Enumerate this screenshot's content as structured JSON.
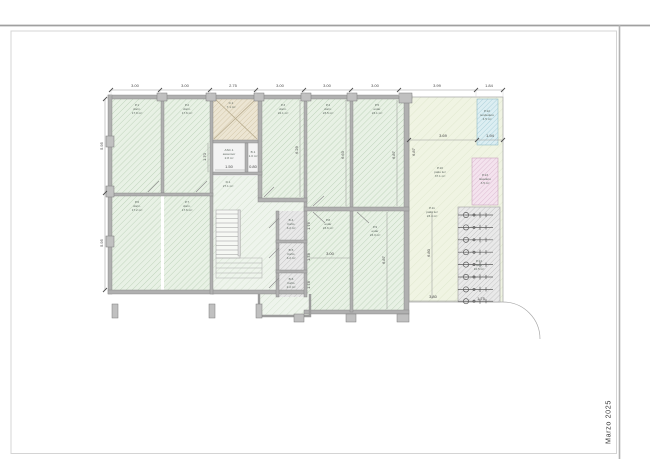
{
  "sheet": {
    "date_label": "Marzo 2025"
  },
  "dims": {
    "top": [
      "3.00",
      "3.00",
      "2.75",
      "3.00",
      "3.00",
      "3.00",
      "3.99",
      "1.84"
    ],
    "left": [
      "5.95",
      "5.95"
    ],
    "patio_row": [
      "3.69",
      "1.94"
    ],
    "v_asc": "1.70",
    "v_room3": "6.29",
    "v_room4": "6.63",
    "v_room5": "6.87",
    "v_wall_right": "6.87",
    "v_room9": "6.87",
    "v_patio": "6.80",
    "v_small": [
      "1.76",
      "1.78",
      "1.78"
    ],
    "h_asc": "1.50",
    "h_wc": "0.80",
    "h_room8": "3.00",
    "h_patio": "3.80",
    "h_bikes": "1.75"
  },
  "rooms": {
    "p1": {
      "id": "P.1",
      "use": "dorm.",
      "area": "17.9 m²"
    },
    "p2": {
      "id": "P.2",
      "use": "dorm.",
      "area": "17.6 m²"
    },
    "p3": {
      "id": "P.3",
      "use": "dorm.",
      "area": "22.1 m²"
    },
    "p4": {
      "id": "P.4",
      "use": "dorm.",
      "area": "23.5 m²"
    },
    "p5": {
      "id": "P.5",
      "use": "estar",
      "area": "23.1 m²"
    },
    "p6": {
      "id": "P.6",
      "use": "dorm.",
      "area": "17.2 m²"
    },
    "p7": {
      "id": "P.7",
      "use": "dorm.",
      "area": "17.6 m²"
    },
    "p8": {
      "id": "P.8",
      "use": "estar",
      "area": "23.6 m²"
    },
    "p9": {
      "id": "P.9",
      "use": "estar",
      "area": "23.3 m²"
    },
    "hall": {
      "id": "D.1",
      "area": "27.1 m²"
    },
    "shaft": {
      "id": "C.1",
      "area": "7.1 m²"
    },
    "asc": {
      "id": "ASC.1",
      "use": "ascensor",
      "area": "2.8 m²"
    },
    "wc": {
      "id": "B.1",
      "area": "1.0 m²"
    },
    "b4": {
      "id": "B.4",
      "use": "baño",
      "area": "3.2 m²"
    },
    "b5": {
      "id": "B.5",
      "use": "baño",
      "area": "3.2 m²"
    },
    "b6": {
      "id": "B.6",
      "use": "baño",
      "area": "2.2 m²"
    },
    "p10": {
      "id": "P.10",
      "use": "patio luz",
      "area": "37.1 m²"
    },
    "p11": {
      "id": "P.11",
      "use": "patio luz",
      "area": "23.4 m²"
    },
    "p12": {
      "id": "P.12",
      "use": "tendedero",
      "area": "4.5 m²"
    },
    "p13": {
      "id": "P.13",
      "use": "lavadero",
      "area": "3.5 m²"
    },
    "p14": {
      "id": "P.14",
      "use": "bicis",
      "area": "10.5 m²"
    }
  },
  "colors": {
    "room_fill": "#e8f1e5",
    "room_hatch": "#bdd2b8",
    "hall_fill": "#eef4ec",
    "hall_hatch": "#d2e0cd",
    "shaft_fill": "#ece5d3",
    "shaft_hatch": "#d2c6a7",
    "gray_fill": "#e9e9e9",
    "gray_hatch": "#c2c2c2",
    "cyan_fill": "#dceef2",
    "cyan_hatch": "#a9cfd9",
    "pink_fill": "#f4e3ee",
    "pink_hatch": "#dcb9d0",
    "terrace_fill": "#f0f4e3",
    "terrace_hatch": "#dde6ca",
    "wall": "#b0b0b0"
  }
}
